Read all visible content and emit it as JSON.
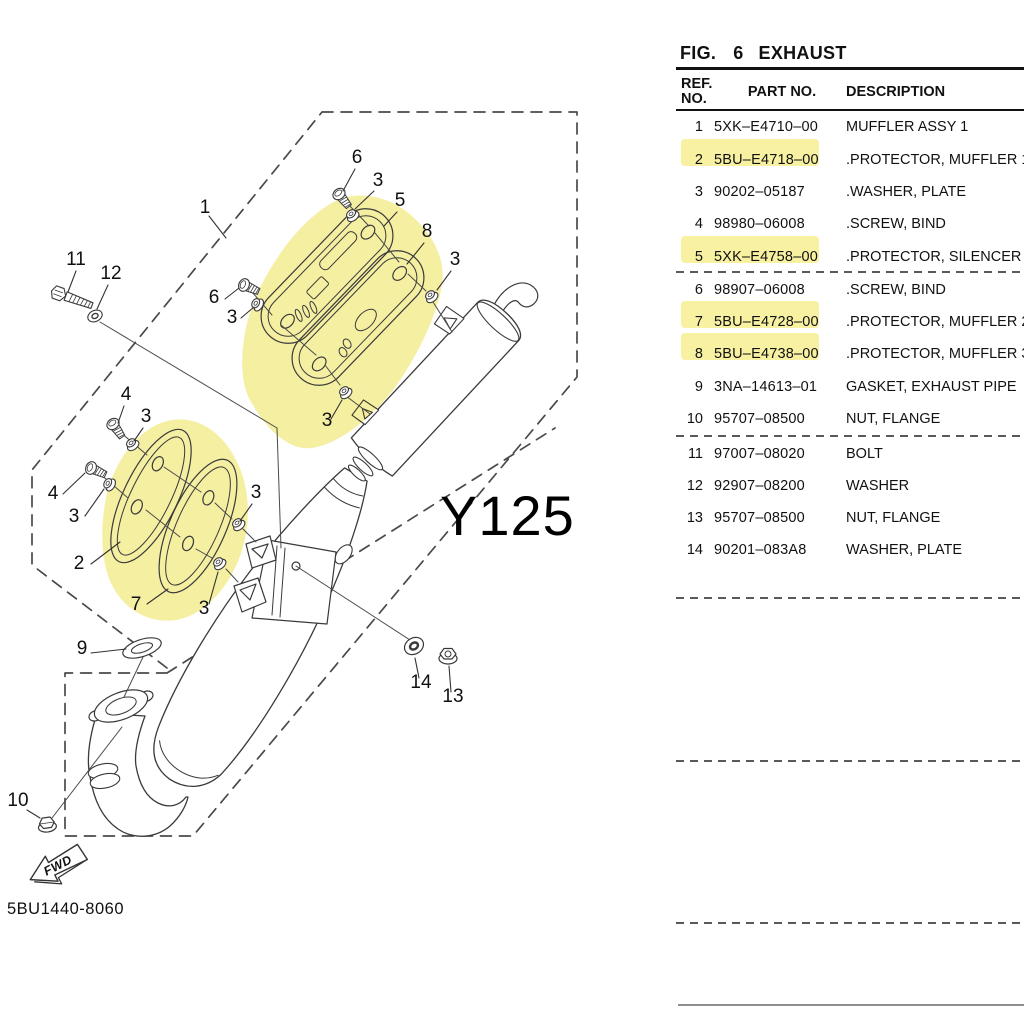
{
  "figure_header": {
    "fig_label": "FIG.",
    "fig_number": "6",
    "title": "EXHAUST"
  },
  "table": {
    "headers": {
      "ref_line1": "REF.",
      "ref_line2": "NO.",
      "part": "PART NO.",
      "description": "DESCRIPTION"
    },
    "highlight_color": "#f7f1a1",
    "rows": [
      {
        "ref": "1",
        "part": "5XK–E4710–00",
        "description": "MUFFLER ASSY 1",
        "highlighted": false
      },
      {
        "ref": "2",
        "part": "5BU–E4718–00",
        "description": ".PROTECTOR, MUFFLER 1",
        "highlighted": true
      },
      {
        "ref": "3",
        "part": "90202–05187",
        "description": ".WASHER, PLATE",
        "highlighted": false
      },
      {
        "ref": "4",
        "part": "98980–06008",
        "description": ".SCREW, BIND",
        "highlighted": false
      },
      {
        "ref": "5",
        "part": "5XK–E4758–00",
        "description": ".PROTECTOR, SILENCER",
        "highlighted": true
      },
      {
        "ref": "6",
        "part": "98907–06008",
        "description": ".SCREW, BIND",
        "highlighted": false
      },
      {
        "ref": "7",
        "part": "5BU–E4728–00",
        "description": ".PROTECTOR, MUFFLER 2",
        "highlighted": true
      },
      {
        "ref": "8",
        "part": "5BU–E4738–00",
        "description": ".PROTECTOR, MUFFLER 3",
        "highlighted": true
      },
      {
        "ref": "9",
        "part": "3NA–14613–01",
        "description": "GASKET, EXHAUST PIPE",
        "highlighted": false
      },
      {
        "ref": "10",
        "part": "95707–08500",
        "description": "NUT, FLANGE",
        "highlighted": false
      },
      {
        "ref": "11",
        "part": "97007–08020",
        "description": "BOLT",
        "highlighted": false
      },
      {
        "ref": "12",
        "part": "92907–08200",
        "description": "WASHER",
        "highlighted": false
      },
      {
        "ref": "13",
        "part": "95707–08500",
        "description": "NUT, FLANGE",
        "highlighted": false
      },
      {
        "ref": "14",
        "part": "90201–083A8",
        "description": "WASHER, PLATE",
        "highlighted": false
      }
    ]
  },
  "diagram": {
    "model_label": "Y125",
    "drawing_number": "5BU1440-8060",
    "fwd_label": "FWD",
    "highlight_color": "#f5efa2",
    "callouts": [
      {
        "label": "1"
      },
      {
        "label": "6"
      },
      {
        "label": "3"
      },
      {
        "label": "5"
      },
      {
        "label": "8"
      },
      {
        "label": "3"
      },
      {
        "label": "6"
      },
      {
        "label": "3"
      },
      {
        "label": "11"
      },
      {
        "label": "12"
      },
      {
        "label": "4"
      },
      {
        "label": "3"
      },
      {
        "label": "4"
      },
      {
        "label": "3"
      },
      {
        "label": "2"
      },
      {
        "label": "7"
      },
      {
        "label": "3"
      },
      {
        "label": "3"
      },
      {
        "label": "3"
      },
      {
        "label": "9"
      },
      {
        "label": "10"
      },
      {
        "label": "14"
      },
      {
        "label": "13"
      }
    ]
  }
}
